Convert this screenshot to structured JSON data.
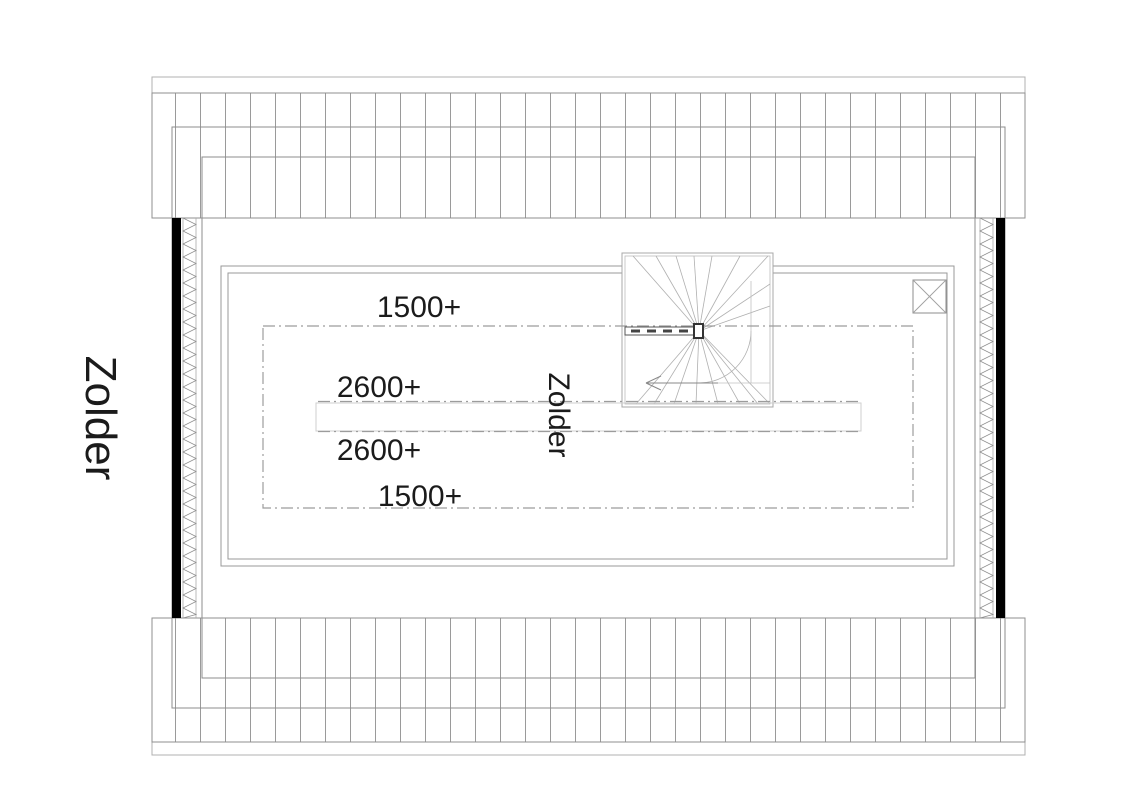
{
  "floor_plan": {
    "floor_title": "Zolder",
    "room_label": "Zolder",
    "height_markers": {
      "front_1500": "1500+",
      "front_2600": "2600+",
      "back_2600": "2600+",
      "back_1500": "1500+"
    }
  },
  "colors": {
    "wall_fill": "#000000",
    "line_dark": "#333333",
    "line_gray": "#979797",
    "line_light": "#b5b5b5",
    "text": "#1b1b1b",
    "background": "#ffffff"
  }
}
